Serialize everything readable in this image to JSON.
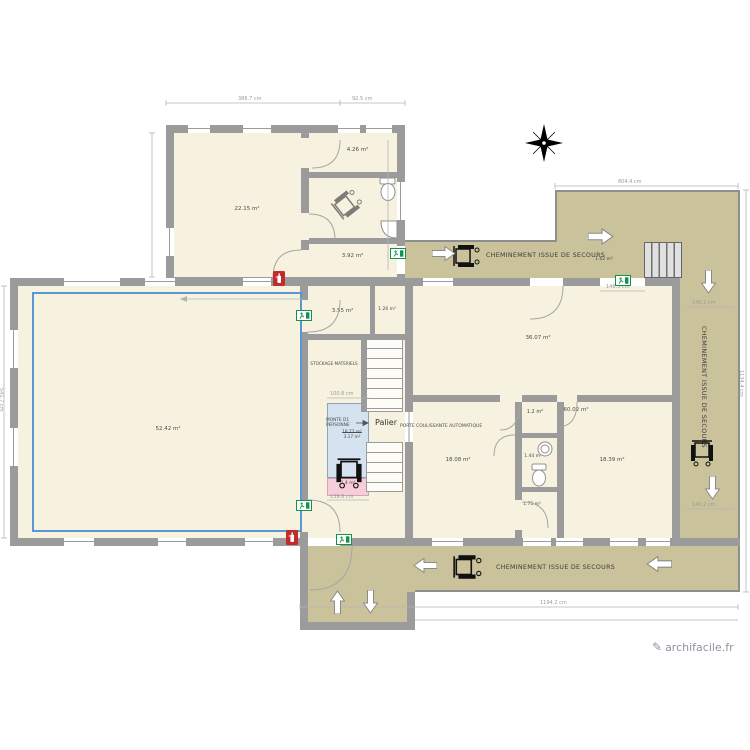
{
  "app": {
    "watermark": "archifacile.fr"
  },
  "colors": {
    "wall": "#9b9b9b",
    "floor": "#f7f2df",
    "corridor": "#cac29b",
    "lift": "#d5e3f1",
    "ramp": "#f6cdd9",
    "selection": "#5a96d2",
    "exit_green": "#14914d",
    "fire_red": "#c22b2b"
  },
  "areas": {
    "atelier": "22.15 m²",
    "small_top": "4.26 m²",
    "back_room": "3.92 m²",
    "hall_left": "3.55 m²",
    "closet": "1.26 m²",
    "main_hall": "52.42 m²",
    "big_right": "36.07 m²",
    "room_mid": "18.08 m²",
    "wc_lobby": "1.2 m²",
    "right_wing": "60.02 m²",
    "sink_room": "1.44 m²",
    "room_right": "18.39 m²",
    "wc_small": "1.75 m²",
    "under_stairs": "1.62 m²",
    "ramp_area": "1.4 m²",
    "lift_area_old": "18.72 m²",
    "lift_area": "3.17 m²"
  },
  "texts": {
    "cheminement": "CHEMINEMENT ISSUE DE SECOURS",
    "palier": "Palier",
    "monte1": "MONTE D1",
    "monte2": "PERSONNE",
    "porte": "PORTE COULISSANTE AUTOMATIQUE",
    "stockage": "STOCKAGE MATERIELS"
  },
  "dims": {
    "top_a": "386.7 cm",
    "top_b": "92.5 cm",
    "notch": "804.4 cm",
    "exit_door": "146.3 cm",
    "corridor_a": "140.2 cm",
    "corridor_b": "140.2 cm",
    "lift_w": "100.8 cm",
    "ramp_w": "139.8 cm",
    "bottom": "1194.2 cm",
    "right_h": "1134.4 cm",
    "left_h": "541.7 cm"
  }
}
